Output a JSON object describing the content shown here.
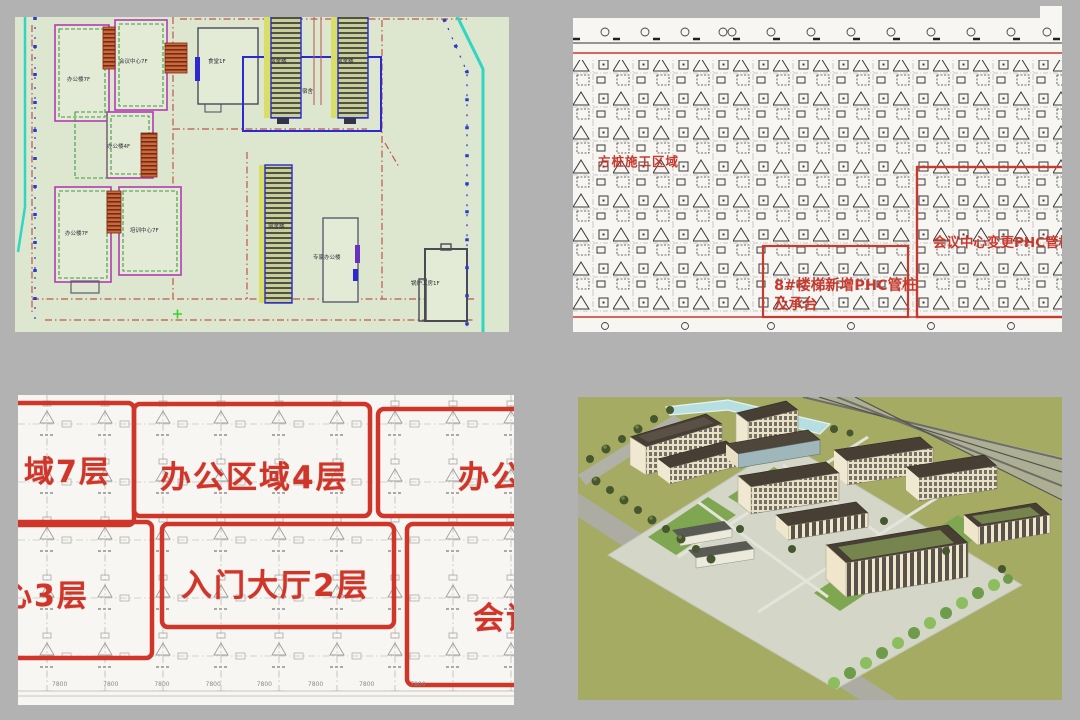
{
  "colors": {
    "page_background": "#b2b2b2",
    "annotation_red": "#c8392e",
    "zone_red": "#d0352a",
    "site_plan_background": "#dde6cf",
    "cad_background": "#f7f6f2",
    "render_ground": "#a5ab63"
  },
  "site_plan": {
    "labels": [
      "办公楼7F",
      "会议中心7F",
      "办公楼4F",
      "办公楼7F",
      "培训中心7F",
      "食堂1F",
      "宿舍楼",
      "宿舍楼",
      "宿舍",
      "宿舍楼",
      "专家办公楼",
      "锅炉工房1F"
    ]
  },
  "pile_plan": {
    "area_label": "方桩施工区域",
    "stair_note_line1": "8#楼梯新增PHC管桩",
    "stair_note_line2": "及承台",
    "center_note": "会议中心变更PHC管桩"
  },
  "zone_plan": {
    "zones": [
      "域7层",
      "办公区域4层",
      "办公",
      "心3层",
      "入门大厅2层",
      "会议"
    ],
    "dims": "7800 7800 7800 7800 7800 7800 7800 7800"
  }
}
